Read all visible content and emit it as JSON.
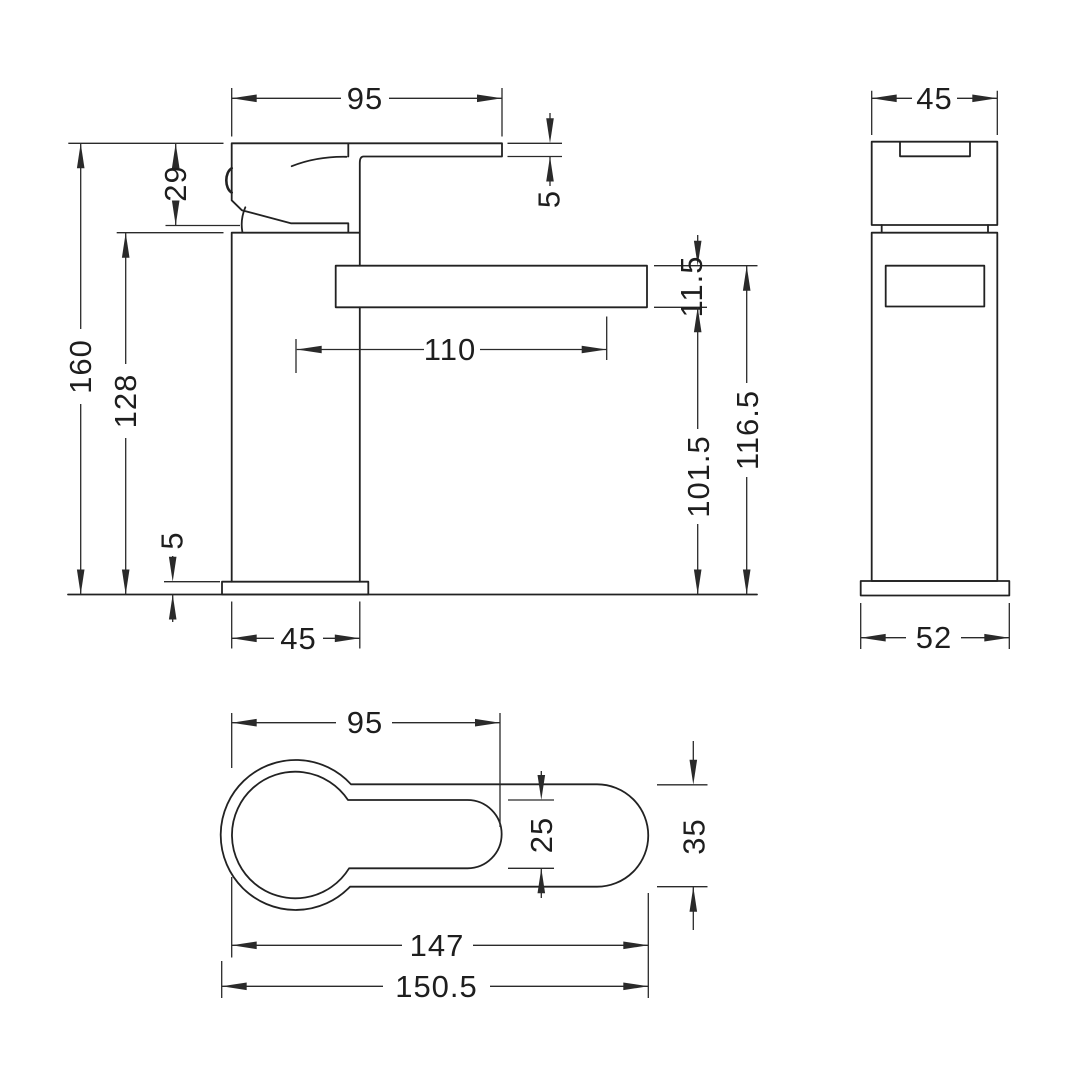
{
  "colors": {
    "line": "#222222",
    "background": "#ffffff"
  },
  "dimensions": {
    "front": {
      "top_width": "95",
      "handle_height": "29",
      "overall_height": "160",
      "body_height": "128",
      "lever_thickness": "5",
      "spout_reach": "110",
      "spout_thickness": "11.5",
      "spout_underside_height": "101.5",
      "spout_top_height": "116.5",
      "base_thickness": "5",
      "body_width": "45"
    },
    "side": {
      "top_width": "45",
      "base_width": "52"
    },
    "plan": {
      "handle_length": "95",
      "handle_width": "25",
      "spout_width": "35",
      "body_length": "147",
      "overall_length": "150.5"
    }
  }
}
